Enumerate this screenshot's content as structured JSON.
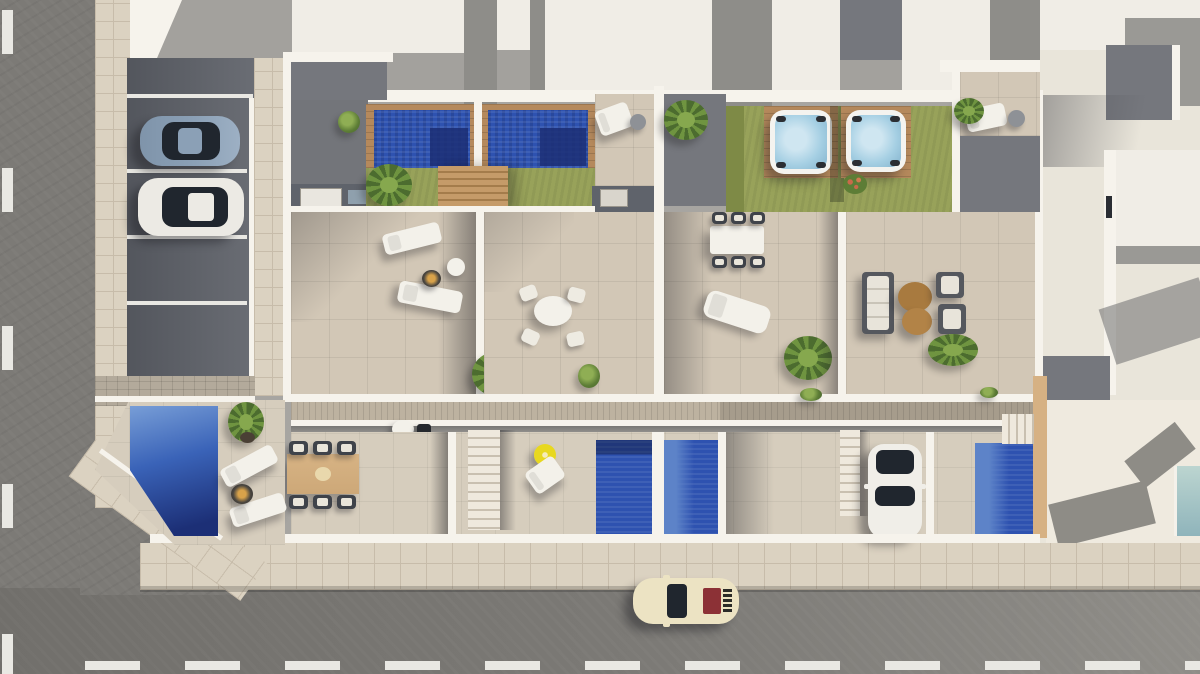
{
  "scene": {
    "type": "aerial-3d-render",
    "subject": "top-down architectural visualization of a residential development with roof-terrace pools, hot tubs, ground-floor yards, parking bays and surrounding streets",
    "visible_text": "none",
    "units": [
      "corner-villa",
      "unit-a",
      "unit-b",
      "unit-c",
      "unit-d",
      "right-neighbor-house",
      "top-neighbor-roofs"
    ],
    "vehicles": [
      {
        "name": "silver-blue-sedan",
        "location": "parking-bay-1",
        "color": "#8ba0b6"
      },
      {
        "name": "white-hatchback",
        "location": "parking-bay-2",
        "color": "#eceae4"
      },
      {
        "name": "white-suv",
        "location": "unit-d-driveway",
        "color": "#f0eee8"
      },
      {
        "name": "cream-classic-car",
        "location": "bottom-street",
        "color": "#ece3c3",
        "detail": "dark red rear engine vent"
      }
    ],
    "water_features": [
      {
        "name": "roof-pool-a",
        "style": "tiled royal blue, wood deck surround"
      },
      {
        "name": "roof-pool-b",
        "style": "tiled royal blue, wood deck surround"
      },
      {
        "name": "hot-tub-c",
        "style": "white rim, pale blue water, wood deck"
      },
      {
        "name": "hot-tub-d",
        "style": "white rim, pale blue water, wood deck"
      },
      {
        "name": "yard-pool-b",
        "style": "royal blue"
      },
      {
        "name": "yard-pool-c",
        "style": "royal blue"
      },
      {
        "name": "yard-pool-d",
        "style": "royal blue, timber side wall"
      },
      {
        "name": "villa-corner-pool",
        "style": "angled edge following street corner, light-to-deep blue"
      },
      {
        "name": "neighbor-pool-glimpse",
        "style": "pale teal, right edge of frame"
      }
    ],
    "amenities": [
      "sun-loungers",
      "round-side-tables",
      "fire-pits",
      "round-dining-set",
      "rect-dining-set-6",
      "timber-dining-table-6",
      "sofa-lounge-set",
      "yellow-parasol",
      "bbq-grill",
      "planted-palms",
      "flower-bush"
    ],
    "street_markings": {
      "left_road": "vertical white dashed lane line",
      "bottom_road": "horizontal white dashed lane line"
    },
    "parking": {
      "bays": 4,
      "occupied": 2,
      "line_color": "#eceae4"
    }
  },
  "palette": {
    "asphalt": "#7c7a76",
    "asphaltDark": "#716f6b",
    "asphaltLight": "#8f8d88",
    "roadLine": "#e9e8e3",
    "sidewalk": "#dbd2c1",
    "sidewalkLine": "#c7bcaa",
    "paver": "#b3aa9b",
    "parking": "#53565d",
    "parkingLight": "#6a6d74",
    "terrace": "#d2c7b6",
    "yard": "#d6cdbd",
    "lawn": "#98a25a",
    "lawnShade": "#7e8a46",
    "poolBlue": "#2e52b0",
    "poolDeep": "#1c2f76",
    "poolSky": "#6f97d2",
    "poolPale": "#a9c8c9",
    "wood": "#b5895c",
    "timberWall": "#d6b183",
    "walkway": "#bdb2a0",
    "wallWhite": "#f6f3ec",
    "roofWhite": "#f0ede6",
    "roofGray": "#75777d",
    "roofGrayLight": "#9a9995",
    "alley": "#5f636b",
    "tubWater": "#a5cfe3",
    "tubRim": "#f4f3ef",
    "glass": "#20262e",
    "carSilver": "#8ba0b6",
    "carWhite": "#eceae4",
    "carCream": "#ece3c3",
    "carRedVent": "#8c3136",
    "umbrella": "#e8d81f",
    "furnWhite": "#f3f1ea",
    "furnWood": "#cda878",
    "tableBrown": "#a87a3f",
    "chairDark": "#3f434a"
  }
}
